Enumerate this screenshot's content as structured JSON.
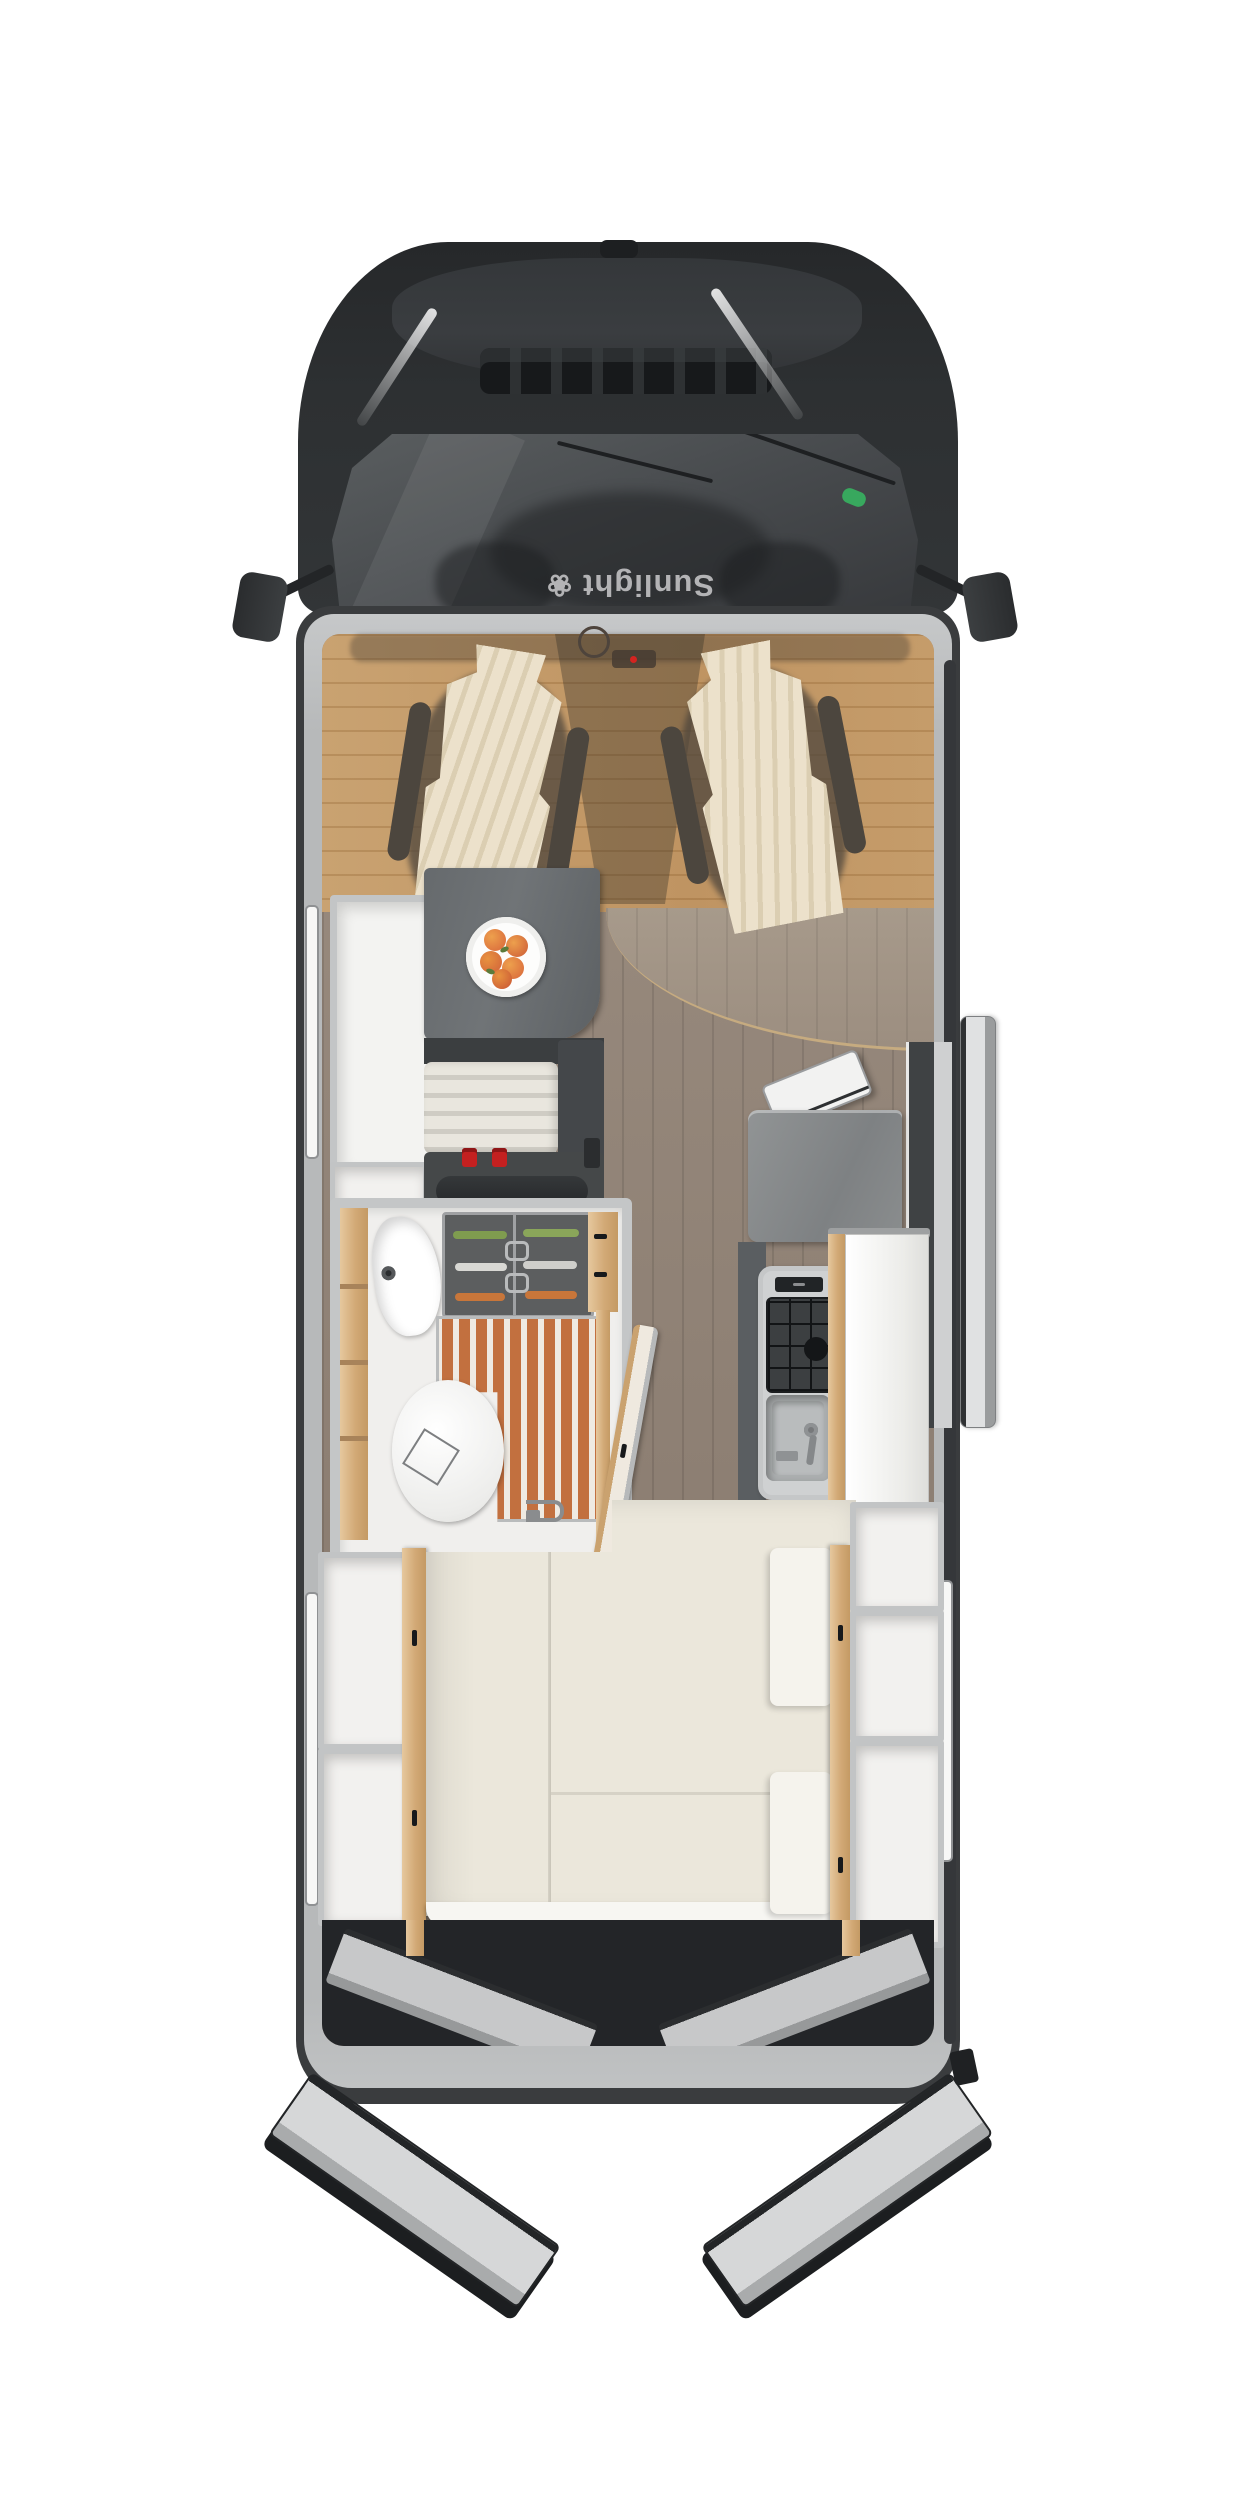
{
  "brand": {
    "logo_text": "Sunlight",
    "logo_mark": "❀",
    "logo_orientation": "rotated 180 degrees on cab cowl"
  },
  "view": {
    "type": "top-down motorhome floor plan render",
    "sections": [
      "cab",
      "swivel-seat lounge",
      "dinette",
      "wardrobe",
      "bathroom",
      "kitchen",
      "fridge",
      "rear-beds",
      "rear-garage"
    ]
  },
  "parts": [
    "cab-roof",
    "roof-antenna",
    "hood",
    "air-intake-grille",
    "windshield",
    "wiper-left",
    "wiper-right",
    "side-mirror-left",
    "side-mirror-right",
    "windshield-sticker",
    "swivel-seat-left",
    "swivel-seat-right",
    "steering-wheel",
    "dashboard-cluster",
    "wardrobe",
    "dinette-table",
    "fruit-plate",
    "bench-seat",
    "seatbelt-buckles",
    "entry-door-open",
    "kitchen-counter",
    "counter-flap",
    "stove",
    "kitchen-sink",
    "fridge-tower",
    "bathroom",
    "vanity-sink",
    "glass-cabinet",
    "shower-slat-floor",
    "toilet",
    "floor-drain",
    "bathroom-door-open",
    "bed-left",
    "bed-right",
    "bed-cushions",
    "storage-niches",
    "wood-dividers",
    "garage-bay",
    "rear-door-left-open",
    "rear-door-right-open"
  ],
  "colors": {
    "background": "#ffffff",
    "cab_dark": "#2d3032",
    "hood_highlight": "#3a3d40",
    "windshield": "#46494c",
    "body_wall": "#b7b9ba",
    "body_edge": "#3a3c3e",
    "lounge_wood": "#c59c6a",
    "plank_floor": "#8d7f73",
    "table_top": "#63676a",
    "bench_stripe": "#cfccc4",
    "seat_cover": "#ece1cb",
    "bed_mattress": "#ebe7db",
    "cushion_white": "#f5f3ed",
    "wood_trim": "#d2a976",
    "shower_slat": "#c2703f",
    "counter_grey": "#8d9091",
    "stove_black": "#1b1d1f",
    "sink_grey": "#a9acad",
    "buckle_red": "#c42020",
    "sticker_green": "#38a85e",
    "fruit_orange": "#de7c38",
    "door_leaf_grey": "#e0e1e2",
    "garage_dark": "#232528"
  }
}
